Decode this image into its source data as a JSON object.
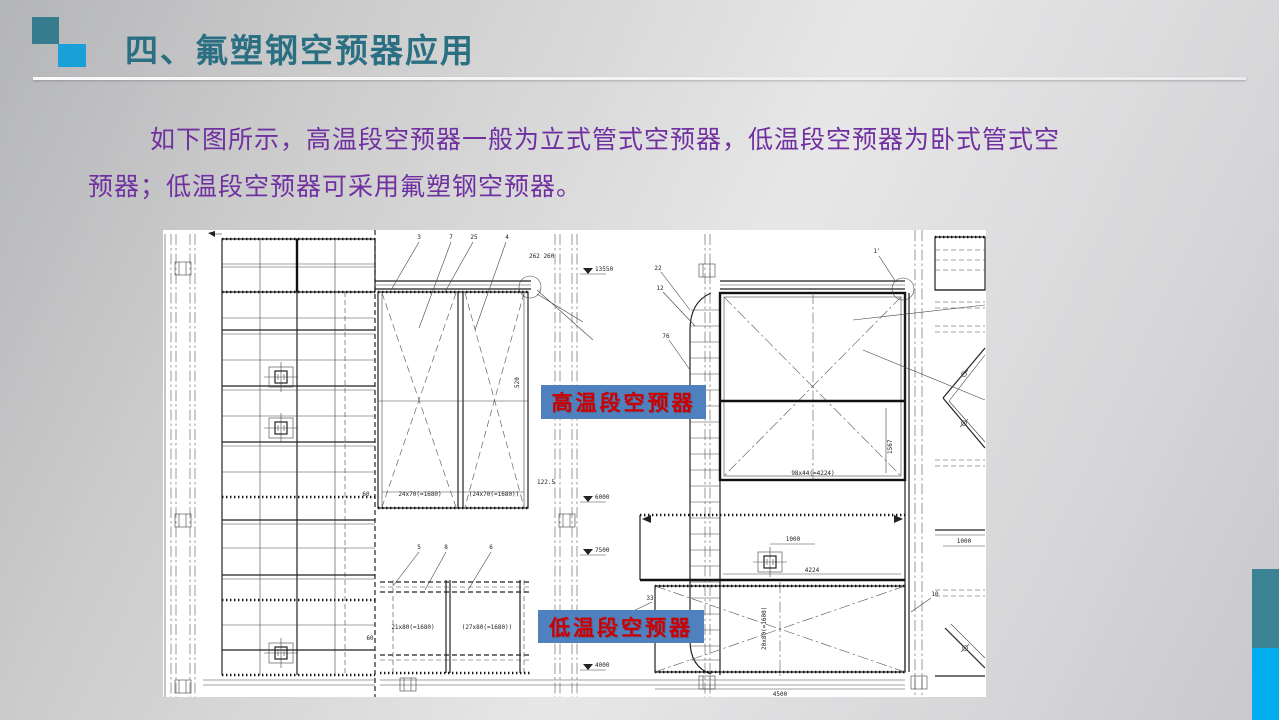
{
  "slide": {
    "title": "四、氟塑钢空预器应用",
    "body_line1": "如下图所示，高温段空预器一般为立式管式空预器，低温段空预器为卧式管式空",
    "body_line2": "预器；低温段空预器可采用氟塑钢空预器。",
    "colors": {
      "title_text": "#2b6f83",
      "body_text": "#7030a0",
      "accent_square_dark": "#377b8e",
      "accent_square_light": "#1b9fd8",
      "sidebar_teal": "#3b8295",
      "sidebar_blue": "#00aeef",
      "label_background": "#4e81bd",
      "label_text": "#cc0000"
    }
  },
  "labels": {
    "high_temp": "高温段空预器",
    "low_temp": "低温段空预器"
  },
  "drawing": {
    "balloons": {
      "n3": "3",
      "n7": "7",
      "n25": "25",
      "n4": "4",
      "n22": "22",
      "n12": "12",
      "n76": "76",
      "n5": "5",
      "n8": "8",
      "n6": "6",
      "n33": "33",
      "n10": "10",
      "n1p": "1'"
    },
    "dims": {
      "elev_top": "13550",
      "elev_mid": "6000",
      "elev_low": "7500",
      "elev_bottom": "4000",
      "d122": "122.5",
      "d262": "262 260",
      "d520": "520",
      "d60": "60",
      "tube_a": "24x70(=1680)",
      "tube_b": "(24x70(=1680))",
      "tube_c": "21x80(=1680)",
      "tube_d": "(27x80(=1680))",
      "d60b": "60",
      "sq": "98x44(=4224)",
      "v1567": "1567",
      "k1000a": "1000",
      "k1000b": "1000",
      "d4224": "4224",
      "d4500": "4500",
      "vlow": "20x80(=1600)"
    }
  }
}
